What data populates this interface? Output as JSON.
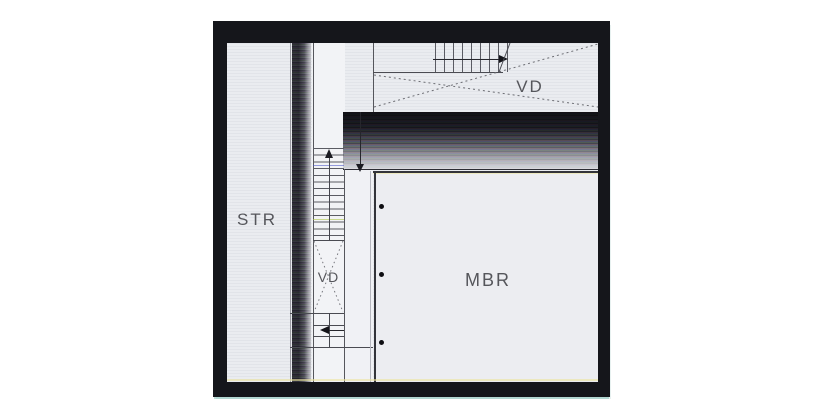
{
  "plan": {
    "rooms": [
      {
        "id": "str",
        "label": "STR"
      },
      {
        "id": "vd-upper",
        "label": "VD"
      },
      {
        "id": "vd-lower",
        "label": "VD"
      },
      {
        "id": "mbr",
        "label": "MBR"
      }
    ],
    "mbr_column_dots": 3,
    "icons": {
      "stair_run_right_arrow": "right-arrow",
      "stair_up_arrow": "up-arrow",
      "stair_down_arrow": "down-arrow",
      "stair_left_arrow": "left-arrow",
      "mbr_dot": "bullet-dot"
    },
    "colors": {
      "frame_black": "#15161b",
      "floor_light": "#eaecf0",
      "wall_line": "#4a4b52",
      "label_text": "#55565b",
      "scan_artifact_yellow": "#ece49e",
      "scan_artifact_teal": "#82c3b7"
    }
  }
}
